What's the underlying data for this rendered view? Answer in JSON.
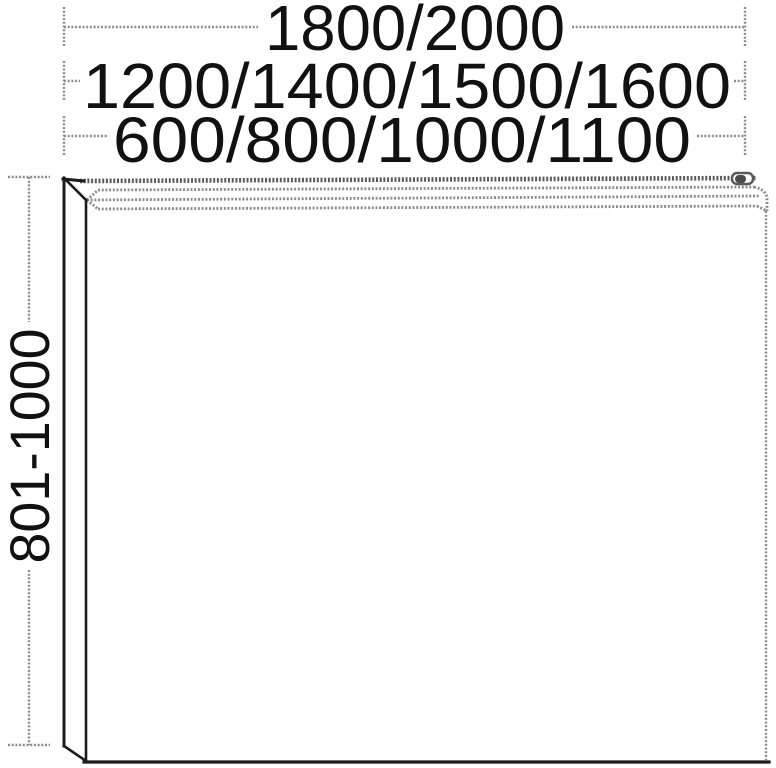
{
  "dimensions": {
    "width_top": "1800/2000",
    "width_middle": "1200/1400/1500/1600",
    "width_bottom": "600/800/1000/1100",
    "height_left": "801-1000"
  },
  "colors": {
    "solid_line": "#1c1c1c",
    "dashed_line": "#8c8c8c",
    "dashed_line_dark": "#5a5a5a",
    "text": "#111111",
    "background": "#ffffff"
  }
}
